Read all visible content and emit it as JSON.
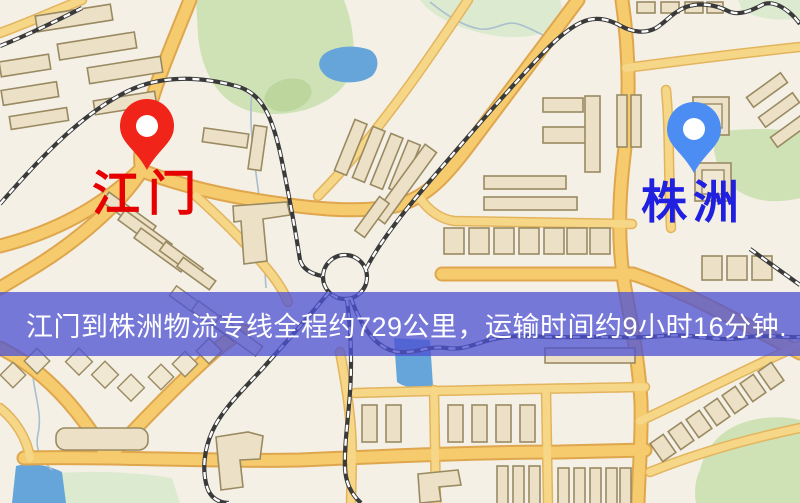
{
  "map": {
    "markers": [
      {
        "id": "origin",
        "label": "江门",
        "pin_color": "#f02418",
        "label_color": "#e60000"
      },
      {
        "id": "destination",
        "label": "株洲",
        "pin_color": "#4b8df2",
        "label_color": "#2020e0"
      }
    ],
    "banner": {
      "text": "江门到株洲物流专线全程约729公里，运输时间约9小时16分钟.",
      "distance_km": "729",
      "duration": "9小时16分钟",
      "background": "#4d51d4",
      "text_color": "#ffffff"
    },
    "legend_colors": {
      "road": "#f5cb6e",
      "building": "#ece1c6",
      "park": "#cfe2b6",
      "water": "#65a5d9",
      "railway": "#3a3a3a"
    }
  }
}
